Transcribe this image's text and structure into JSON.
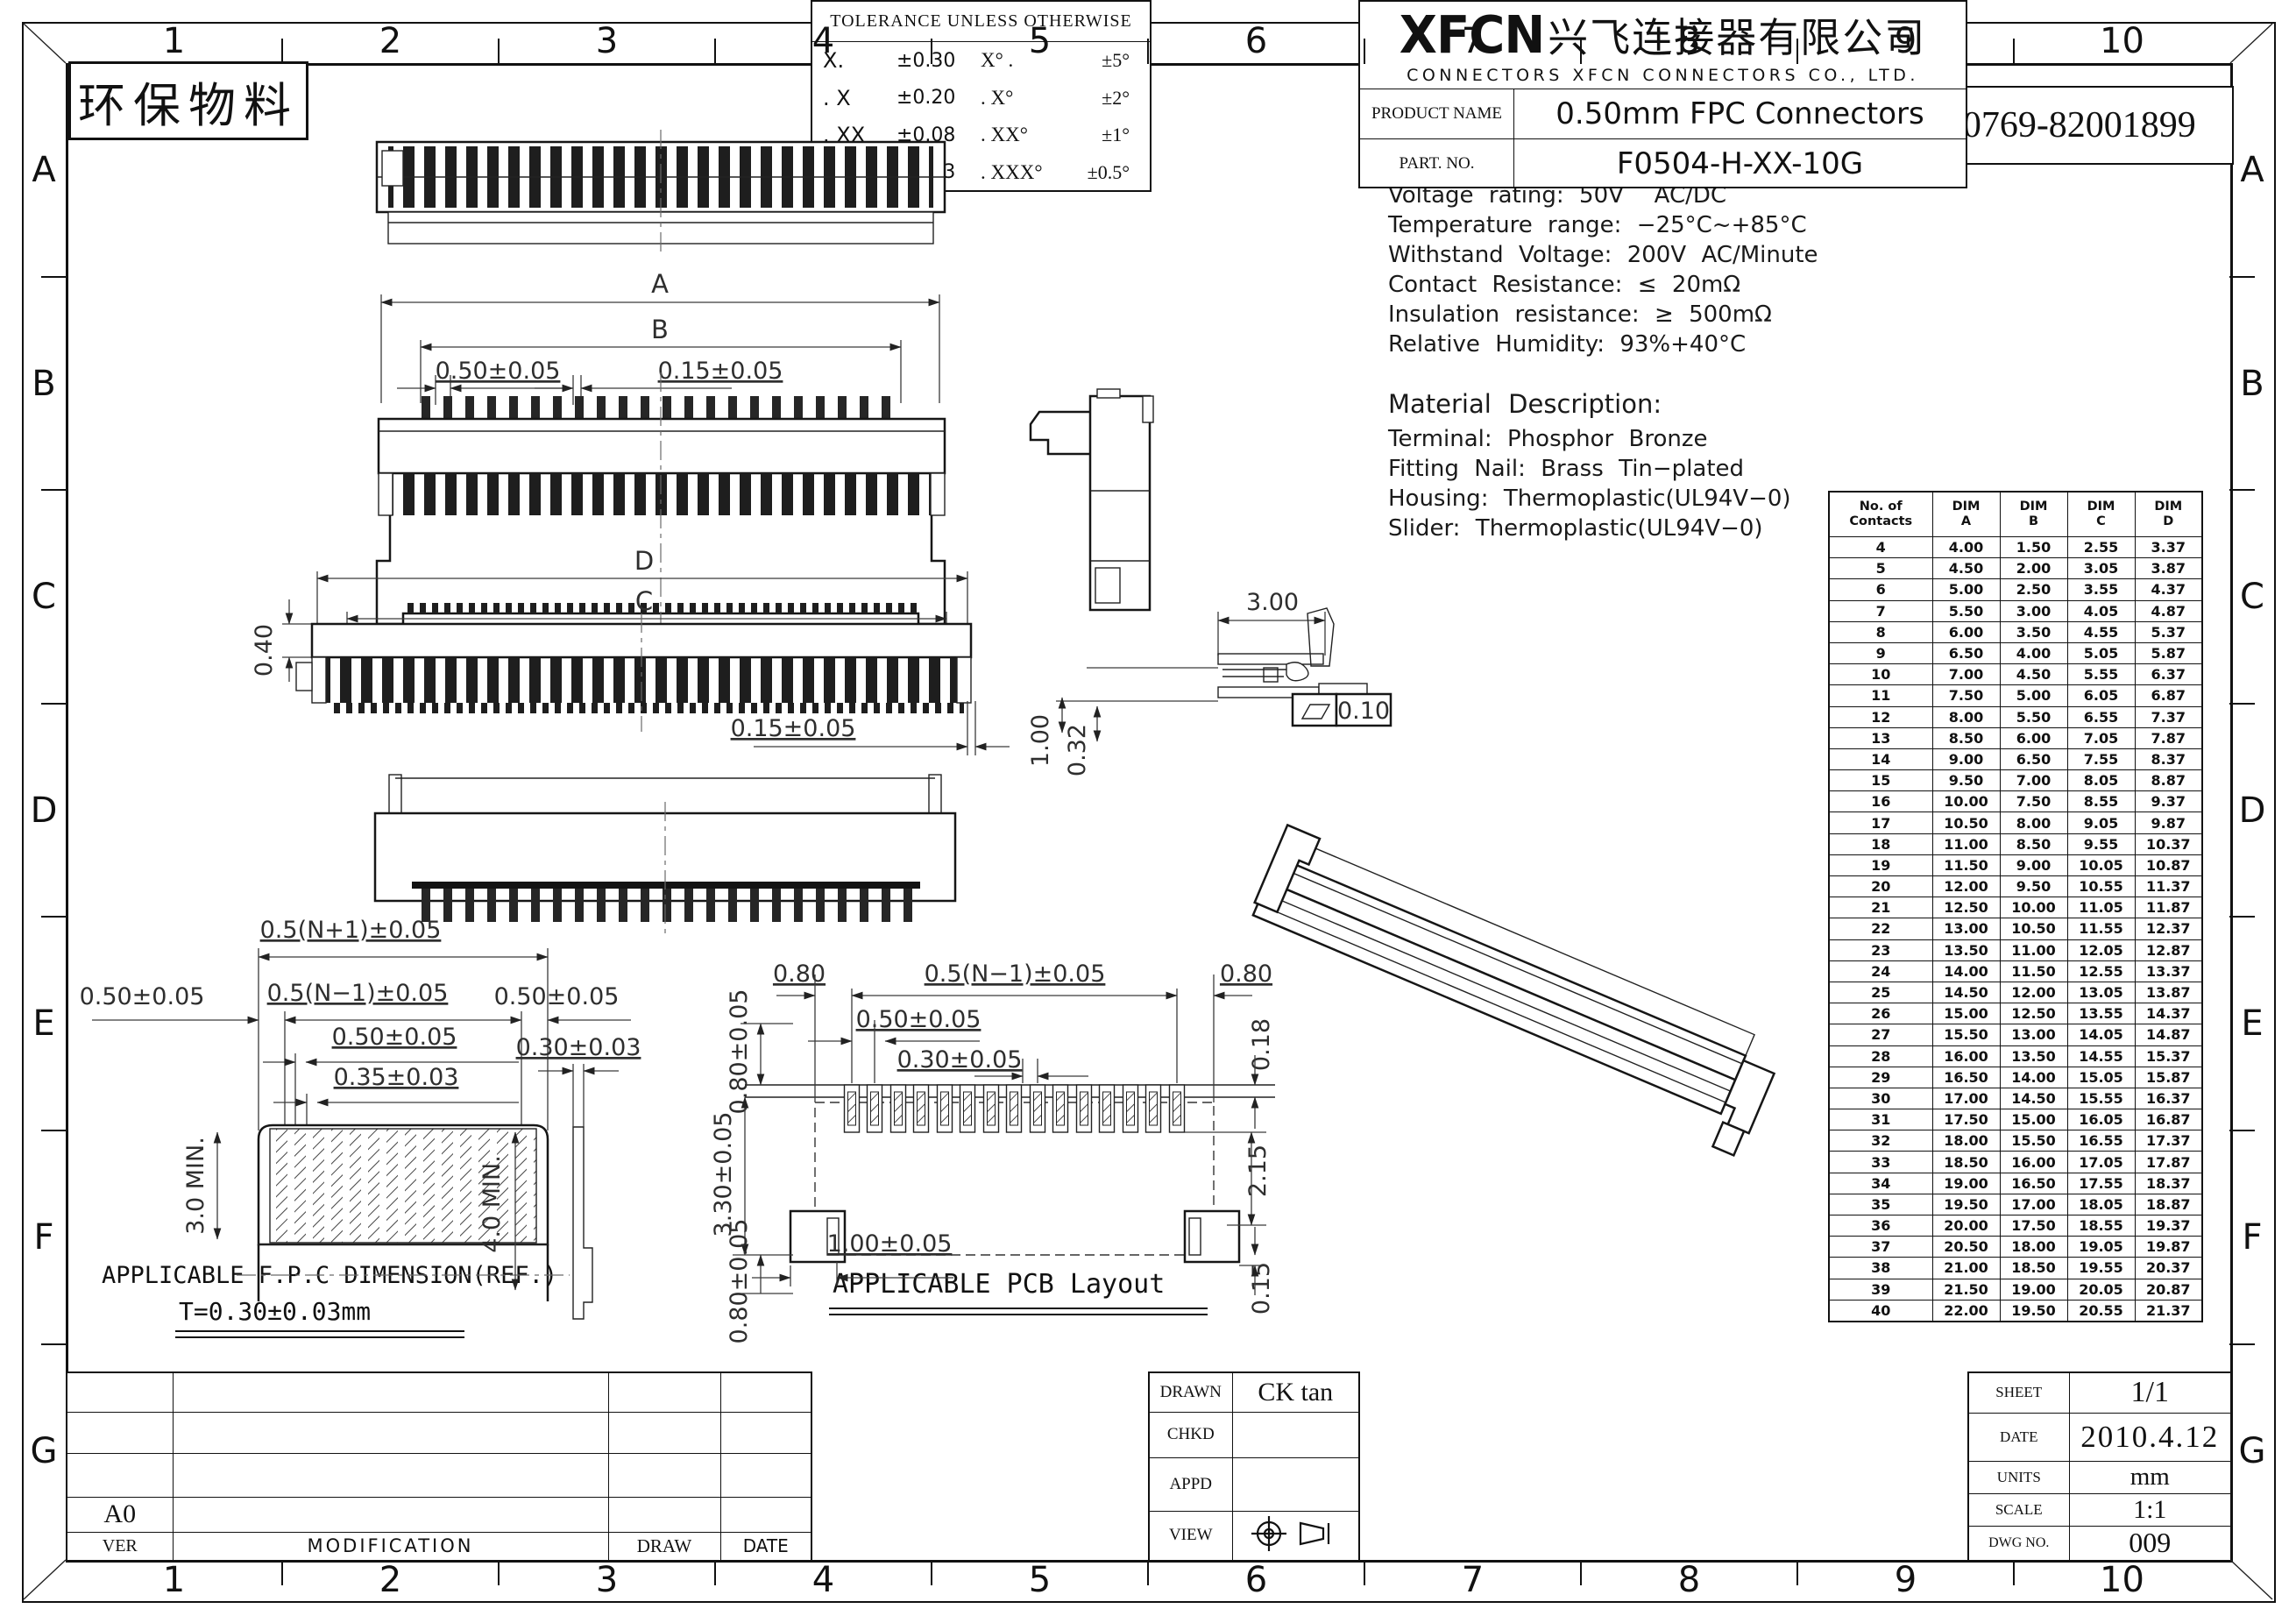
{
  "header": {
    "eco_label": "环保物料",
    "tel": "TEL:0769-82001899"
  },
  "zones": {
    "cols": [
      "1",
      "2",
      "3",
      "4",
      "5",
      "6",
      "7",
      "8",
      "9",
      "10"
    ],
    "rows": [
      "A",
      "B",
      "C",
      "D",
      "E",
      "F",
      "G"
    ]
  },
  "electrical": {
    "title": "Electrical Characteristics:",
    "lines": [
      "Current rating: 0.4A AC/DC",
      "Voltage rating: 50V  AC/DC",
      "Temperature range: −25°C~+85°C",
      "Withstand Voltage: 200V AC/Minute",
      "Contact Resistance: ≤ 20mΩ",
      "Insulation resistance: ≥ 500mΩ",
      "Relative Humidity: 93%+40°C"
    ]
  },
  "material": {
    "title": "Material Description:",
    "lines": [
      "Terminal: Phosphor Bronze",
      "Fitting Nail: Brass Tin−plated",
      "Housing: Thermoplastic(UL94V−0)",
      "Slider: Thermoplastic(UL94V−0)"
    ]
  },
  "dim_table": {
    "headers": [
      [
        "No. of",
        "Contacts"
      ],
      [
        "DIM",
        "A"
      ],
      [
        "DIM",
        "B"
      ],
      [
        "DIM",
        "C"
      ],
      [
        "DIM",
        "D"
      ]
    ],
    "rows": [
      [
        "4",
        "4.00",
        "1.50",
        "2.55",
        "3.37"
      ],
      [
        "5",
        "4.50",
        "2.00",
        "3.05",
        "3.87"
      ],
      [
        "6",
        "5.00",
        "2.50",
        "3.55",
        "4.37"
      ],
      [
        "7",
        "5.50",
        "3.00",
        "4.05",
        "4.87"
      ],
      [
        "8",
        "6.00",
        "3.50",
        "4.55",
        "5.37"
      ],
      [
        "9",
        "6.50",
        "4.00",
        "5.05",
        "5.87"
      ],
      [
        "10",
        "7.00",
        "4.50",
        "5.55",
        "6.37"
      ],
      [
        "11",
        "7.50",
        "5.00",
        "6.05",
        "6.87"
      ],
      [
        "12",
        "8.00",
        "5.50",
        "6.55",
        "7.37"
      ],
      [
        "13",
        "8.50",
        "6.00",
        "7.05",
        "7.87"
      ],
      [
        "14",
        "9.00",
        "6.50",
        "7.55",
        "8.37"
      ],
      [
        "15",
        "9.50",
        "7.00",
        "8.05",
        "8.87"
      ],
      [
        "16",
        "10.00",
        "7.50",
        "8.55",
        "9.37"
      ],
      [
        "17",
        "10.50",
        "8.00",
        "9.05",
        "9.87"
      ],
      [
        "18",
        "11.00",
        "8.50",
        "9.55",
        "10.37"
      ],
      [
        "19",
        "11.50",
        "9.00",
        "10.05",
        "10.87"
      ],
      [
        "20",
        "12.00",
        "9.50",
        "10.55",
        "11.37"
      ],
      [
        "21",
        "12.50",
        "10.00",
        "11.05",
        "11.87"
      ],
      [
        "22",
        "13.00",
        "10.50",
        "11.55",
        "12.37"
      ],
      [
        "23",
        "13.50",
        "11.00",
        "12.05",
        "12.87"
      ],
      [
        "24",
        "14.00",
        "11.50",
        "12.55",
        "13.37"
      ],
      [
        "25",
        "14.50",
        "12.00",
        "13.05",
        "13.87"
      ],
      [
        "26",
        "15.00",
        "12.50",
        "13.55",
        "14.37"
      ],
      [
        "27",
        "15.50",
        "13.00",
        "14.05",
        "14.87"
      ],
      [
        "28",
        "16.00",
        "13.50",
        "14.55",
        "15.37"
      ],
      [
        "29",
        "16.50",
        "14.00",
        "15.05",
        "15.87"
      ],
      [
        "30",
        "17.00",
        "14.50",
        "15.55",
        "16.37"
      ],
      [
        "31",
        "17.50",
        "15.00",
        "16.05",
        "16.87"
      ],
      [
        "32",
        "18.00",
        "15.50",
        "16.55",
        "17.37"
      ],
      [
        "33",
        "18.50",
        "16.00",
        "17.05",
        "17.87"
      ],
      [
        "34",
        "19.00",
        "16.50",
        "17.55",
        "18.37"
      ],
      [
        "35",
        "19.50",
        "17.00",
        "18.05",
        "18.87"
      ],
      [
        "36",
        "20.00",
        "17.50",
        "18.55",
        "19.37"
      ],
      [
        "37",
        "20.50",
        "18.00",
        "19.05",
        "19.87"
      ],
      [
        "38",
        "21.00",
        "18.50",
        "19.55",
        "20.37"
      ],
      [
        "39",
        "21.50",
        "19.00",
        "20.05",
        "20.87"
      ],
      [
        "40",
        "22.00",
        "19.50",
        "20.55",
        "21.37"
      ]
    ]
  },
  "dims": {
    "front1_a": "A",
    "front1_b": "B",
    "front1_pitch": "0.50±0.05",
    "front1_tab": "0.15±0.05",
    "front2_d": "D",
    "front2_c": "C",
    "front2_h": "0.40",
    "front2_tab": "0.15±0.05",
    "section_w": "3.00",
    "section_flat": "0.10",
    "section_h1": "1.00",
    "section_h2": "0.32",
    "fpc_total": "0.5(N+1)±0.05",
    "fpc_left": "0.50±0.05",
    "fpc_span": "0.5(N−1)±0.05",
    "fpc_right": "0.50±0.05",
    "fpc_pitch": "0.50±0.05",
    "fpc_finger": "0.35±0.03",
    "fpc_min_l": "3.0 MIN.",
    "fpc_min_r": "4.0 MIN.",
    "fpc_thick": "0.30±0.03",
    "pcb_edge_l": "0.80",
    "pcb_span": "0.5(N−1)±0.05",
    "pcb_edge_r": "0.80",
    "pcb_pitch": "0.50±0.05",
    "pcb_pad_w": "0.30±0.05",
    "pcb_top": "0.80±0.05",
    "pcb_height": "3.30±0.05",
    "pcb_bottom": "0.80±0.05",
    "pcb_r1": "0.18",
    "pcb_r2": "2.15",
    "pcb_r3": "0.15",
    "pcb_anchor": "1.00±0.05"
  },
  "captions": {
    "fpc_title": "APPLICABLE F.P.C DIMENSION(REF.)",
    "fpc_sub": "T=0.30±0.03mm",
    "pcb_title": "APPLICABLE PCB Layout"
  },
  "title_block": {
    "revision": {
      "ver_value": "A0",
      "ver": "VER",
      "modification": "MODIFICATION",
      "draw": "DRAW",
      "date": "DATE"
    },
    "tolerance": {
      "title": "TOLERANCE UNLESS OTHERWISE",
      "rows": [
        [
          "X.",
          "±0.30",
          "X° .",
          "±5°"
        ],
        [
          ". X",
          "±0.20",
          ". X°",
          "±2°"
        ],
        [
          ". XX",
          "±0.08",
          ". XX°",
          "±1°"
        ],
        [
          ". XXX",
          "±0.03",
          ". XXX°",
          "±0.5°"
        ]
      ]
    },
    "approval": {
      "drawn_label": "DRAWN",
      "drawn_value": "CK tan",
      "chkd_label": "CHKD",
      "appd_label": "APPD",
      "view_label": "VIEW"
    },
    "company": {
      "logo": "XFCN",
      "name_cn": "兴飞连接器有限公司",
      "name_en": "CONNECTORS XFCN CONNECTORS CO., LTD."
    },
    "product": {
      "label": "PRODUCT NAME",
      "value": "0.50mm FPC Connectors"
    },
    "part": {
      "label": "PART.  NO.",
      "value": "F0504-H-XX-10G"
    },
    "info": {
      "sheet_label": "SHEET",
      "sheet_value": "1/1",
      "date_label": "DATE",
      "date_value": "2010.4.12",
      "units_label": "UNITS",
      "units_value": "mm",
      "scale_label": "SCALE",
      "scale_value": "1:1",
      "dwg_label": "DWG NO.",
      "dwg_value": "009"
    }
  }
}
